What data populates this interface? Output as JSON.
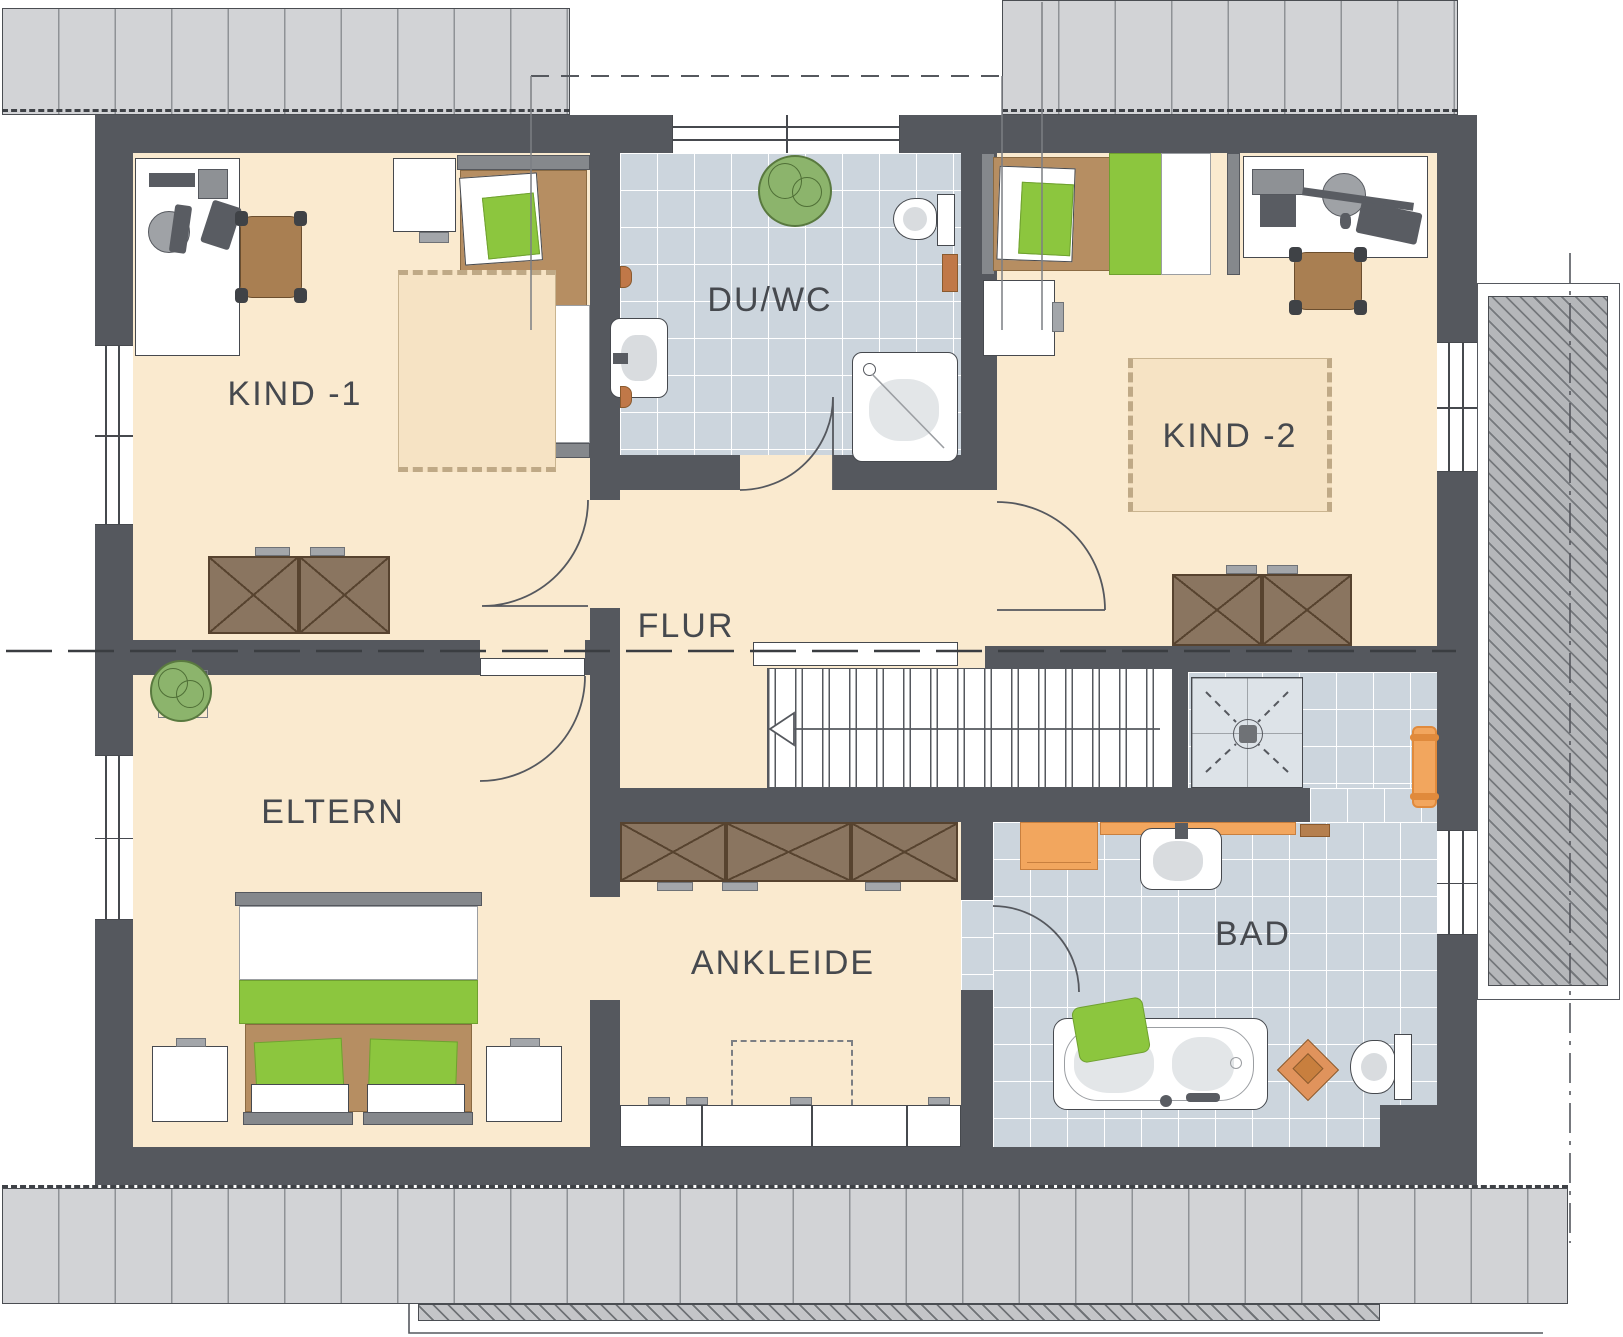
{
  "title": "Dachgeschoss Grundriss",
  "colors": {
    "wall": "#55585e",
    "line": "#46494e",
    "floor": "#faeacf",
    "tile": "#ccd5dd",
    "roof": "#d2d3d6",
    "roofline": "#8f9296",
    "hatch": "#b5b7ba",
    "rug": "#f6e3c4",
    "green": "#8cc63e",
    "duvet": "#b68e62",
    "wood": "#8a7560",
    "woodline": "#57432f",
    "orange": "#f2a65e"
  },
  "rooms": [
    {
      "id": "kind1",
      "label": "KIND -1"
    },
    {
      "id": "duwc",
      "label": "DU/WC"
    },
    {
      "id": "kind2",
      "label": "KIND -2"
    },
    {
      "id": "flur",
      "label": "FLUR"
    },
    {
      "id": "eltern",
      "label": "ELTERN"
    },
    {
      "id": "ankleide",
      "label": "ANKLEIDE"
    },
    {
      "id": "bad",
      "label": "BAD"
    }
  ]
}
